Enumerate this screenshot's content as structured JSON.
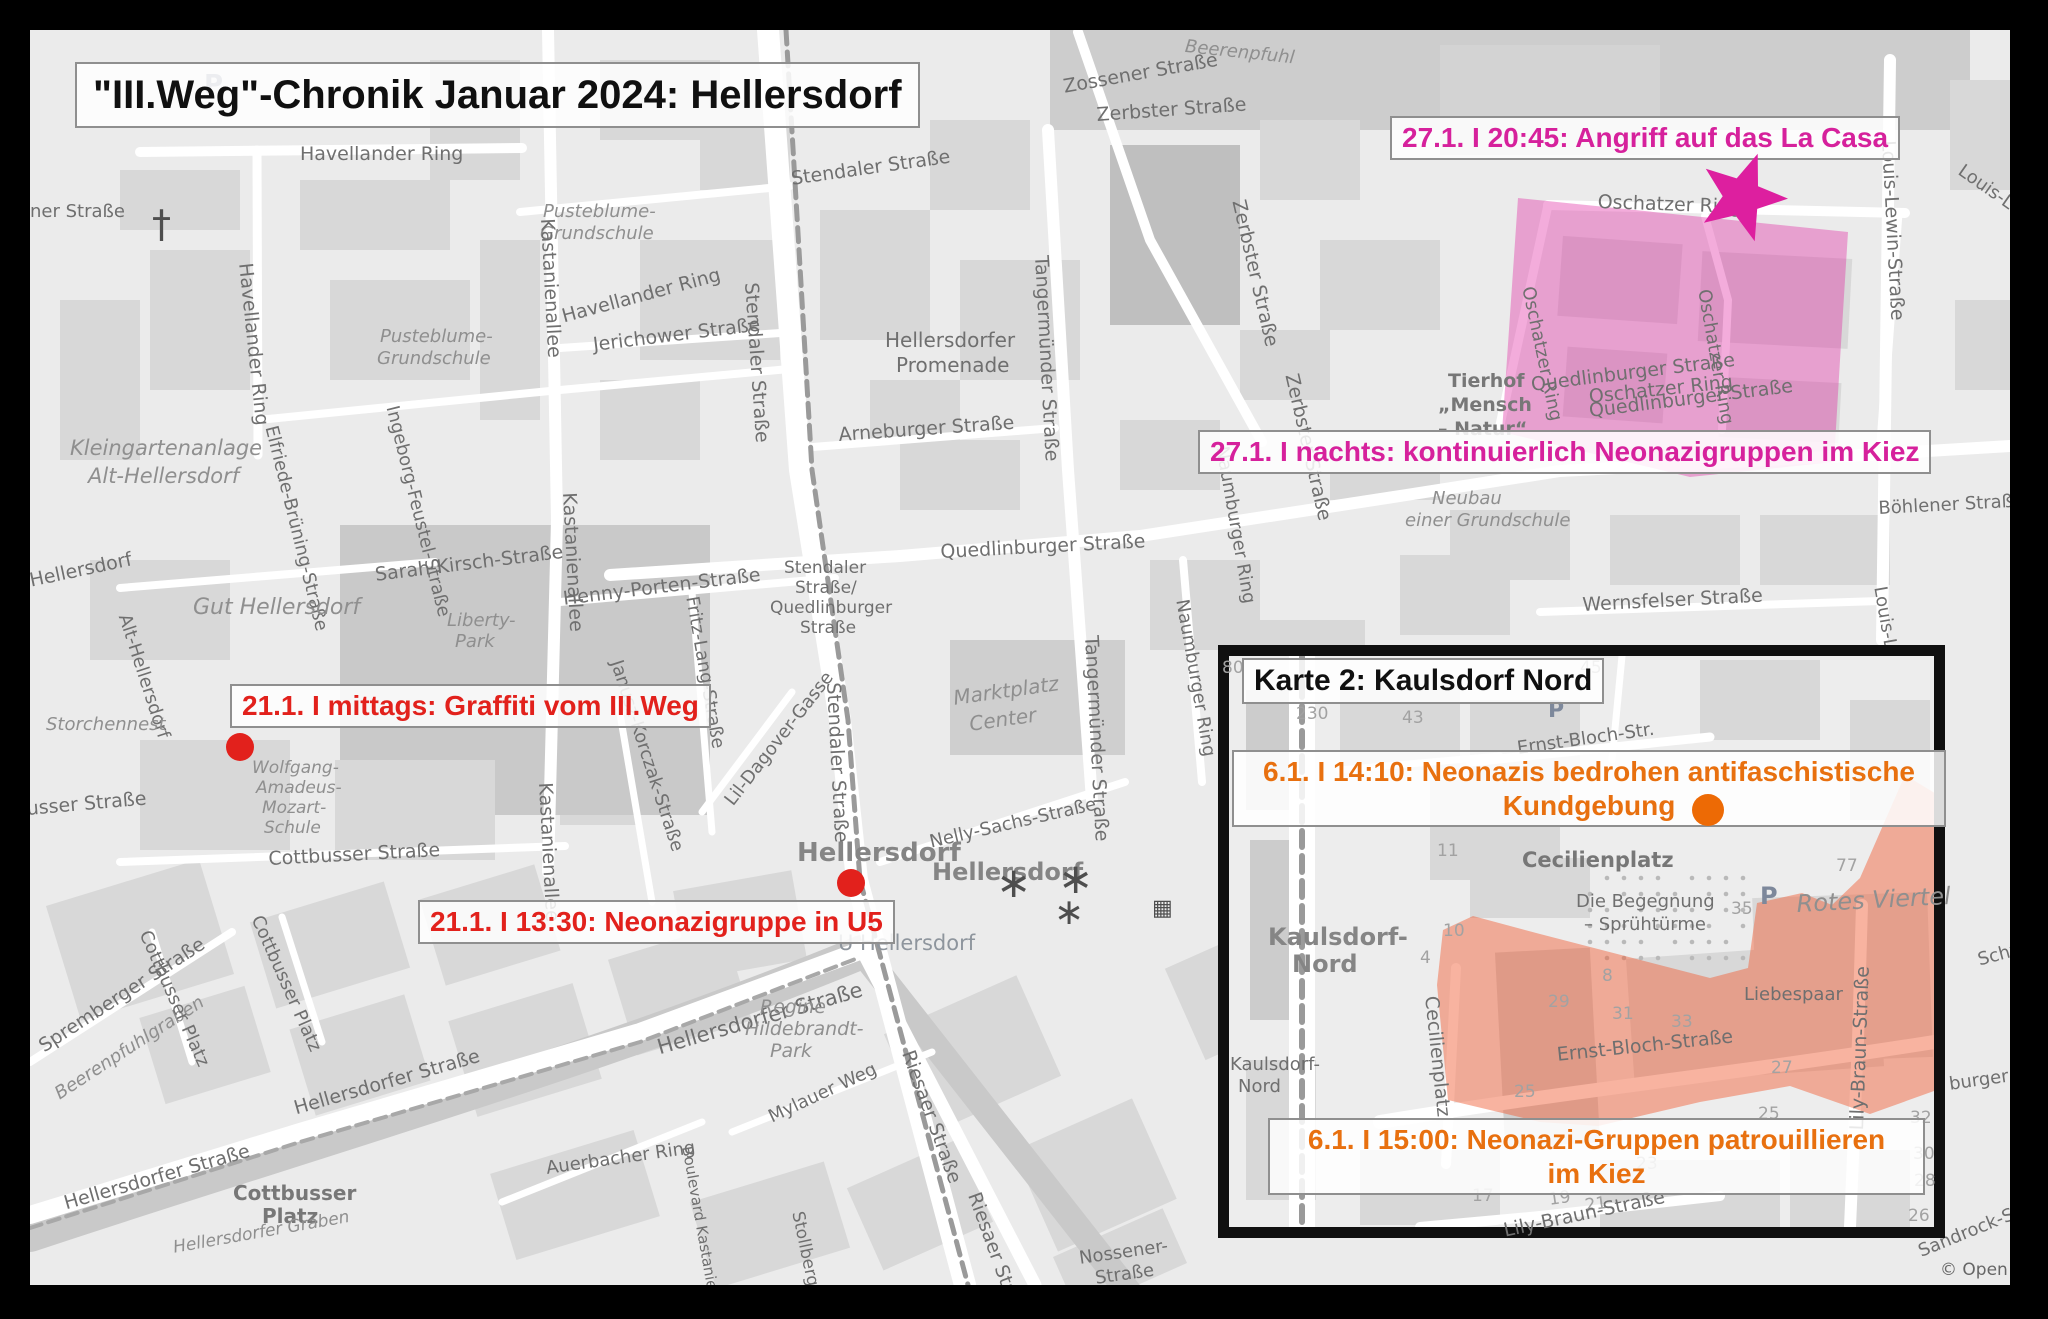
{
  "title": "\"III.Weg\"-Chronik Januar 2024: Hellersdorf",
  "colors": {
    "red": "#e2211c",
    "magenta": "#d6219c",
    "orange": "#e8700f",
    "map_bg": "#ebebeb",
    "frame": "#000000"
  },
  "events": {
    "la_casa": {
      "text": "27.1. I 20:45: Angriff auf das La Casa"
    },
    "kiez_nacht": {
      "text": "27.1. I nachts: kontinuierlich Neonazigruppen im Kiez"
    },
    "graffiti": {
      "text": "21.1. I mittags: Graffiti vom III.Weg"
    },
    "u5": {
      "text": "21.1. I 13:30: Neonazigruppe in U5"
    },
    "kundgebung": {
      "line1": "6.1. I 14:10: Neonazis bedrohen antifaschistische",
      "line2": "Kundgebung"
    },
    "patrouille": {
      "line1": "6.1. I 15:00: Neonazi-Gruppen patrouillieren",
      "line2": "im Kiez"
    }
  },
  "inset": {
    "title": "Karte 2: Kaulsdorf Nord"
  },
  "areas": [
    {
      "name": "kiez-nacht-area",
      "fill": "rgba(224,48,164,0.40)",
      "points": "1518,198 1848,232 1840,360 1834,462 1690,477 1502,432"
    },
    {
      "name": "patrouille-area",
      "fill": "rgba(240,96,56,0.48)",
      "points": "1443,930 1473,916 1540,934 1710,978 1748,968 1757,903 1802,893 1832,905 1860,878 1905,775 1946,800 1948,1086 1870,1114 1790,1086 1700,1102 1598,1126 1540,1122 1448,1100 1437,985"
    }
  ],
  "markers": [
    {
      "name": "la-casa-star",
      "type": "star",
      "x": 1742,
      "y": 197,
      "size": 46,
      "rot": 20,
      "color": "#dd1f9f"
    },
    {
      "name": "graffiti-dot",
      "type": "dot",
      "x": 240,
      "y": 747,
      "r": 14,
      "color": "#e2211c"
    },
    {
      "name": "u5-dot",
      "type": "dot",
      "x": 851,
      "y": 883,
      "r": 14,
      "color": "#e2211c"
    },
    {
      "name": "kundgebung-dot",
      "type": "dot",
      "x": 1708,
      "y": 810,
      "r": 16,
      "color": "#ed6a05"
    }
  ],
  "map_labels": {
    "main": [
      {
        "t": "Zossener Straße",
        "x": 1062,
        "y": 78,
        "r": -10
      },
      {
        "t": "Beerenpfuhl",
        "x": 1186,
        "y": 38,
        "r": 6,
        "k": "it",
        "s": 18
      },
      {
        "t": "Havellander Ring",
        "x": 300,
        "y": 145
      },
      {
        "t": "Havellander Ring",
        "x": 254,
        "y": 262,
        "r": 84
      },
      {
        "t": "Havellander Ring",
        "x": 560,
        "y": 308,
        "r": -15
      },
      {
        "t": "Pusteblume-",
        "x": 380,
        "y": 328,
        "k": "it",
        "s": 18
      },
      {
        "t": "Grundschule",
        "x": 377,
        "y": 350,
        "k": "it",
        "s": 18
      },
      {
        "t": "Pusteblume-",
        "x": 543,
        "y": 203,
        "k": "it",
        "s": 18
      },
      {
        "t": "Grundschule",
        "x": 540,
        "y": 225,
        "k": "it",
        "s": 18
      },
      {
        "t": "Kastanienallee",
        "x": 556,
        "y": 218,
        "r": 87
      },
      {
        "t": "Kastanienallee",
        "x": 578,
        "y": 492,
        "r": 87
      },
      {
        "t": "Kastanienallee",
        "x": 554,
        "y": 782,
        "r": 87
      },
      {
        "t": "Stendaler Straße",
        "x": 790,
        "y": 170,
        "r": -8
      },
      {
        "t": "Jerichower Straße",
        "x": 592,
        "y": 336,
        "r": -7
      },
      {
        "t": "Hellersdorfer",
        "x": 885,
        "y": 330,
        "s": 20
      },
      {
        "t": "Promenade",
        "x": 896,
        "y": 355,
        "s": 20
      },
      {
        "t": "Tangermünder Straße",
        "x": 1050,
        "y": 255,
        "r": 87
      },
      {
        "t": "Tangermünder Straße",
        "x": 1100,
        "y": 635,
        "r": 87
      },
      {
        "t": "Arneburger Straße",
        "x": 838,
        "y": 426,
        "r": -4
      },
      {
        "t": "Zerbster Straße",
        "x": 1096,
        "y": 106,
        "r": -4
      },
      {
        "t": "Zerbster Straße",
        "x": 1247,
        "y": 198,
        "r": 77
      },
      {
        "t": "Zerbster Straße",
        "x": 1300,
        "y": 372,
        "r": 77
      },
      {
        "t": "Stendaler Straße",
        "x": 760,
        "y": 282,
        "r": 86
      },
      {
        "t": "Stendaler Straße",
        "x": 842,
        "y": 682,
        "r": 87
      },
      {
        "t": "Stendaler",
        "x": 784,
        "y": 560,
        "s": 17
      },
      {
        "t": "Straße/",
        "x": 795,
        "y": 580,
        "s": 17
      },
      {
        "t": "Quedlinburger",
        "x": 770,
        "y": 600,
        "s": 17
      },
      {
        "t": "Straße",
        "x": 800,
        "y": 620,
        "s": 17
      },
      {
        "t": "Quedlinburger Straße",
        "x": 940,
        "y": 543,
        "r": -3
      },
      {
        "t": "Marktplatz",
        "x": 952,
        "y": 688,
        "r": -8,
        "k": "it",
        "s": 20
      },
      {
        "t": "Center",
        "x": 968,
        "y": 714,
        "r": -8,
        "k": "it",
        "s": 20
      },
      {
        "t": "Henny-Porten-Straße",
        "x": 562,
        "y": 590,
        "r": -7
      },
      {
        "t": "Fritz-Lang-Straße",
        "x": 700,
        "y": 595,
        "r": 80,
        "s": 18
      },
      {
        "t": "Janusz-Korczak-Straße",
        "x": 624,
        "y": 658,
        "r": 72,
        "s": 18
      },
      {
        "t": "Lil-Dagover-Gasse",
        "x": 722,
        "y": 798,
        "r": -52,
        "s": 18
      },
      {
        "t": "Kleingartenanlage",
        "x": 70,
        "y": 438,
        "k": "it",
        "s": 21
      },
      {
        "t": "Alt-Hellersdorf",
        "x": 88,
        "y": 466,
        "k": "it",
        "s": 21
      },
      {
        "t": "Elfriede-Brüning-Straße",
        "x": 279,
        "y": 424,
        "r": 76,
        "s": 18
      },
      {
        "t": "Ingeborg-Feustel-Straße",
        "x": 400,
        "y": 404,
        "r": 76,
        "s": 18
      },
      {
        "t": "Sarah-Kirsch-Straße",
        "x": 374,
        "y": 566,
        "r": -7
      },
      {
        "t": "Gut Hellersdorf",
        "x": 193,
        "y": 597,
        "k": "it",
        "s": 22
      },
      {
        "t": "Liberty-",
        "x": 447,
        "y": 612,
        "k": "it",
        "s": 18
      },
      {
        "t": "Park",
        "x": 455,
        "y": 633,
        "k": "it",
        "s": 18
      },
      {
        "t": "Alt-Hellersdorf",
        "x": 132,
        "y": 612,
        "r": 72,
        "s": 18
      },
      {
        "t": "Hellersdorf",
        "x": 28,
        "y": 572,
        "r": -12
      },
      {
        "t": "ner Straße",
        "x": 30,
        "y": 203,
        "s": 18
      },
      {
        "t": "Storchennest",
        "x": 46,
        "y": 716,
        "k": "it",
        "s": 18
      },
      {
        "t": "Wolfgang-",
        "x": 252,
        "y": 760,
        "k": "it",
        "s": 17
      },
      {
        "t": "Amadeus-",
        "x": 256,
        "y": 780,
        "k": "it",
        "s": 17
      },
      {
        "t": "Mozart-",
        "x": 262,
        "y": 800,
        "k": "it",
        "s": 17
      },
      {
        "t": "Schule",
        "x": 264,
        "y": 820,
        "k": "it",
        "s": 17
      },
      {
        "t": "Cottbusser Straße",
        "x": 268,
        "y": 850,
        "r": -3
      },
      {
        "t": "usser Straße",
        "x": 26,
        "y": 800,
        "r": -5
      },
      {
        "t": "Hellersdorfer Straße",
        "x": 62,
        "y": 1195,
        "r": -16
      },
      {
        "t": "Hellersdorfer Straße",
        "x": 292,
        "y": 1100,
        "r": -16
      },
      {
        "t": "Hellersdorfer Straße",
        "x": 655,
        "y": 1038,
        "r": -16,
        "s": 21
      },
      {
        "t": "Spremberger Straße",
        "x": 36,
        "y": 1040,
        "r": -33
      },
      {
        "t": "Beerenpfuhlgraben",
        "x": 52,
        "y": 1088,
        "r": -33,
        "k": "it",
        "s": 18
      },
      {
        "t": "Cottbusser Platz",
        "x": 152,
        "y": 928,
        "r": 66,
        "s": 18
      },
      {
        "t": "Cottbusser Platz",
        "x": 264,
        "y": 913,
        "r": 66,
        "s": 18
      },
      {
        "t": "Cottbusser",
        "x": 233,
        "y": 1183,
        "k": "pl",
        "s": 20
      },
      {
        "t": "Platz",
        "x": 262,
        "y": 1206,
        "k": "pl",
        "s": 20
      },
      {
        "t": "Hellersdorfer Graben",
        "x": 172,
        "y": 1240,
        "r": -10,
        "k": "it",
        "s": 17
      },
      {
        "t": "Mylauer Weg",
        "x": 766,
        "y": 1110,
        "r": -25,
        "s": 18
      },
      {
        "t": "Auerbacher Ring",
        "x": 545,
        "y": 1160,
        "r": -8,
        "s": 18
      },
      {
        "t": "Boulevard Kastanienallee",
        "x": 694,
        "y": 1145,
        "r": 80,
        "s": 15
      },
      {
        "t": "Stollberger Straße",
        "x": 805,
        "y": 1210,
        "r": 78,
        "s": 17
      },
      {
        "t": "Regine",
        "x": 760,
        "y": 998,
        "k": "it"
      },
      {
        "t": "Hildebrandt-",
        "x": 745,
        "y": 1020,
        "k": "it"
      },
      {
        "t": "Park",
        "x": 770,
        "y": 1042,
        "k": "it"
      },
      {
        "t": "Hellersdorf",
        "x": 797,
        "y": 840,
        "k": "big",
        "s": 26
      },
      {
        "t": "Hellersdorf",
        "x": 932,
        "y": 860,
        "k": "big",
        "s": 24
      },
      {
        "t": "U Hellersdorf",
        "x": 838,
        "y": 933,
        "k": "u",
        "s": 21
      },
      {
        "t": "Nelly-Sachs-Straße",
        "x": 928,
        "y": 834,
        "r": -13,
        "s": 18
      },
      {
        "t": "Riesaer Straße",
        "x": 916,
        "y": 1048,
        "r": 70
      },
      {
        "t": "Riesaer Straße",
        "x": 982,
        "y": 1190,
        "r": 70
      },
      {
        "t": "Heidenauer Straße",
        "x": 1352,
        "y": 1020,
        "r": -27
      },
      {
        "t": "Rathener Straße",
        "x": 1440,
        "y": 1158,
        "r": -27
      },
      {
        "t": "Nossener-",
        "x": 1078,
        "y": 1250,
        "r": -8,
        "s": 18
      },
      {
        "t": "Straße",
        "x": 1094,
        "y": 1270,
        "r": -8,
        "s": 18
      },
      {
        "t": "Nossener",
        "x": 1168,
        "y": 1288,
        "r": -3,
        "s": 18
      },
      {
        "t": "Naumburger Ring",
        "x": 1190,
        "y": 598,
        "r": 80,
        "s": 18
      },
      {
        "t": "Naumburger Ring",
        "x": 1230,
        "y": 445,
        "r": 80,
        "s": 18
      },
      {
        "t": "Wernsfelser Straße",
        "x": 1582,
        "y": 596,
        "r": -3
      },
      {
        "t": "Böhlener Straße",
        "x": 1878,
        "y": 500,
        "r": -3,
        "s": 18
      },
      {
        "t": "Louis-Lewin-Straße",
        "x": 1897,
        "y": 140,
        "r": 87
      },
      {
        "t": "Louis-Lew",
        "x": 1888,
        "y": 585,
        "r": 80,
        "s": 18
      },
      {
        "t": "Oschatzer Ring",
        "x": 1598,
        "y": 193,
        "r": 2
      },
      {
        "t": "Oschatzer Ring",
        "x": 1588,
        "y": 388,
        "r": -6
      },
      {
        "t": "Oschatzer Ring",
        "x": 1536,
        "y": 285,
        "r": 78,
        "s": 18
      },
      {
        "t": "Oschatzer Ring",
        "x": 1712,
        "y": 288,
        "r": 80,
        "s": 18
      },
      {
        "t": "Quedlinburger Straße",
        "x": 1530,
        "y": 376,
        "r": -7
      },
      {
        "t": "Quedlinburger Straße",
        "x": 1588,
        "y": 402,
        "r": -7
      },
      {
        "t": "Tierhof",
        "x": 1448,
        "y": 372,
        "k": "pl"
      },
      {
        "t": "„Mensch",
        "x": 1438,
        "y": 396,
        "k": "pl"
      },
      {
        "t": "– Natur“",
        "x": 1438,
        "y": 420,
        "k": "pl"
      },
      {
        "t": "Neubau",
        "x": 1432,
        "y": 490,
        "k": "it",
        "s": 18
      },
      {
        "t": "einer Grundschule",
        "x": 1405,
        "y": 512,
        "k": "it",
        "s": 18
      },
      {
        "t": "∗",
        "x": 996,
        "y": 862,
        "s": 42,
        "k": "ic"
      },
      {
        "t": "∗",
        "x": 1058,
        "y": 858,
        "s": 42,
        "k": "ic"
      },
      {
        "t": "∗",
        "x": 1054,
        "y": 895,
        "s": 36,
        "k": "ic"
      },
      {
        "t": "†",
        "x": 152,
        "y": 205,
        "s": 38,
        "k": "ic"
      },
      {
        "t": "P",
        "x": 204,
        "y": 72,
        "s": 26,
        "k": "pk"
      },
      {
        "t": "▦",
        "x": 1152,
        "y": 898,
        "s": 22,
        "k": "ic"
      },
      {
        "t": "Louis-Le",
        "x": 1965,
        "y": 162,
        "r": 35,
        "s": 18
      },
      {
        "t": "Schw",
        "x": 1976,
        "y": 952,
        "r": -15,
        "s": 18
      },
      {
        "t": "burger Stra",
        "x": 1948,
        "y": 1076,
        "r": -8,
        "s": 18
      },
      {
        "t": "Sandrock-St",
        "x": 1916,
        "y": 1244,
        "r": -22,
        "s": 18
      },
      {
        "t": "© Open",
        "x": 1940,
        "y": 1262,
        "s": 17,
        "k": "at"
      }
    ],
    "inset": [
      {
        "t": "80",
        "x": 1222,
        "y": 660,
        "k": "num"
      },
      {
        "t": "230",
        "x": 1296,
        "y": 706,
        "k": "num"
      },
      {
        "t": "43",
        "x": 1402,
        "y": 710,
        "k": "num"
      },
      {
        "t": "45",
        "x": 1580,
        "y": 660,
        "k": "num"
      },
      {
        "t": "P",
        "x": 1548,
        "y": 700,
        "k": "pk",
        "s": 22
      },
      {
        "t": "11",
        "x": 1437,
        "y": 843,
        "k": "num"
      },
      {
        "t": "10",
        "x": 1443,
        "y": 923,
        "k": "num"
      },
      {
        "t": "4",
        "x": 1420,
        "y": 950,
        "k": "num"
      },
      {
        "t": "8",
        "x": 1602,
        "y": 968,
        "k": "num"
      },
      {
        "t": "29",
        "x": 1548,
        "y": 994,
        "k": "num"
      },
      {
        "t": "31",
        "x": 1612,
        "y": 1006,
        "k": "num"
      },
      {
        "t": "33",
        "x": 1671,
        "y": 1014,
        "k": "num"
      },
      {
        "t": "25",
        "x": 1514,
        "y": 1084,
        "k": "num"
      },
      {
        "t": "35",
        "x": 1731,
        "y": 901,
        "k": "num"
      },
      {
        "t": "77",
        "x": 1836,
        "y": 858,
        "k": "num"
      },
      {
        "t": "27",
        "x": 1771,
        "y": 1060,
        "k": "num"
      },
      {
        "t": "25",
        "x": 1758,
        "y": 1106,
        "k": "num"
      },
      {
        "t": "23",
        "x": 1636,
        "y": 1156,
        "k": "num"
      },
      {
        "t": "19",
        "x": 1548,
        "y": 1192,
        "r": -8,
        "k": "num"
      },
      {
        "t": "21",
        "x": 1584,
        "y": 1198,
        "r": -8,
        "k": "num"
      },
      {
        "t": "17",
        "x": 1472,
        "y": 1188,
        "k": "num"
      },
      {
        "t": "32",
        "x": 1910,
        "y": 1110,
        "k": "num"
      },
      {
        "t": "30",
        "x": 1913,
        "y": 1146,
        "k": "num"
      },
      {
        "t": "28",
        "x": 1914,
        "y": 1173,
        "k": "num"
      },
      {
        "t": "26",
        "x": 1908,
        "y": 1208,
        "k": "num"
      },
      {
        "t": "Kaulsdorf-",
        "x": 1268,
        "y": 925,
        "k": "big",
        "s": 24
      },
      {
        "t": "Nord",
        "x": 1292,
        "y": 952,
        "k": "big",
        "s": 24
      },
      {
        "t": "Kaulsdorf-",
        "x": 1230,
        "y": 1056,
        "s": 18
      },
      {
        "t": "Nord",
        "x": 1238,
        "y": 1078,
        "s": 18
      },
      {
        "t": "Cecilienplatz",
        "x": 1522,
        "y": 850,
        "k": "pl",
        "s": 21
      },
      {
        "t": "Die Begegnung",
        "x": 1576,
        "y": 893,
        "s": 18
      },
      {
        "t": "– Sprühtürme",
        "x": 1584,
        "y": 916,
        "s": 18
      },
      {
        "t": "Cecilienplatz",
        "x": 1440,
        "y": 995,
        "r": 84
      },
      {
        "t": "Ernst-Bloch-Straße",
        "x": 1556,
        "y": 1046,
        "r": -6
      },
      {
        "t": "Ernst-Bloch-Str.",
        "x": 1516,
        "y": 740,
        "r": -8,
        "s": 18
      },
      {
        "t": "Rotes Viertel",
        "x": 1796,
        "y": 892,
        "r": -3,
        "k": "it",
        "s": 24
      },
      {
        "t": "Liebespaar",
        "x": 1744,
        "y": 986,
        "s": 18
      },
      {
        "t": "P",
        "x": 1760,
        "y": 884,
        "k": "pk",
        "s": 24
      },
      {
        "t": "Lily-Braun-Straße",
        "x": 1848,
        "y": 1130,
        "r": -88
      },
      {
        "t": "Lily-Braun-Straße",
        "x": 1502,
        "y": 1222,
        "r": -12
      }
    ]
  }
}
